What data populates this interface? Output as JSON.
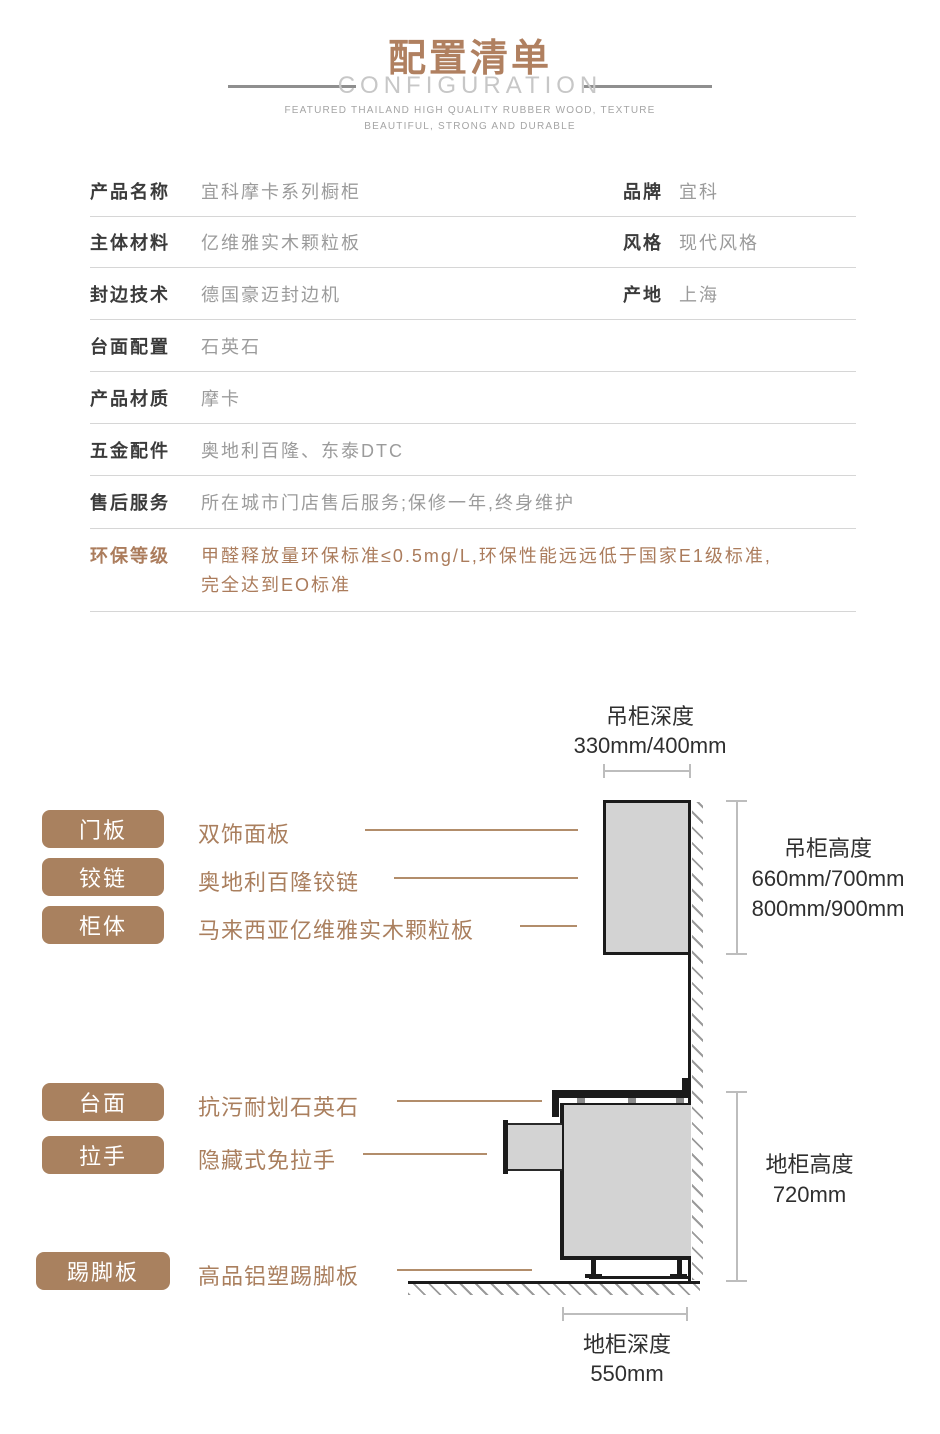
{
  "header": {
    "title": "配置清单",
    "subtitle": "CONFIGURATION",
    "tagline_line1": "FEATURED THAILAND HIGH QUALITY RUBBER WOOD, TEXTURE",
    "tagline_line2": "BEAUTIFUL, STRONG AND DURABLE"
  },
  "spec_table": {
    "rows": [
      {
        "label": "产品名称",
        "value": "宜科摩卡系列橱柜",
        "label2": "品牌",
        "value2": "宜科"
      },
      {
        "label": "主体材料",
        "value": "亿维雅实木颗粒板",
        "label2": "风格",
        "value2": "现代风格"
      },
      {
        "label": "封边技术",
        "value": "德国豪迈封边机",
        "label2": "产地",
        "value2": "上海"
      },
      {
        "label": "台面配置",
        "value": "石英石"
      },
      {
        "label": "产品材质",
        "value": "摩卡"
      },
      {
        "label": "五金配件",
        "value": "奥地利百隆、东泰DTC"
      },
      {
        "label": "售后服务",
        "value": "所在城市门店售后服务;保修一年,终身维护"
      },
      {
        "label": "环保等级",
        "value_line1": "甲醛释放量环保标准≤0.5mg/L,环保性能远远低于国家E1级标准,",
        "value_line2": "完全达到EO标准"
      }
    ]
  },
  "component_labels": [
    {
      "tag": "门板",
      "desc": "双饰面板"
    },
    {
      "tag": "铰链",
      "desc": "奥地利百隆铰链"
    },
    {
      "tag": "柜体",
      "desc": "马来西亚亿维雅实木颗粒板"
    },
    {
      "tag": "台面",
      "desc": "抗污耐划石英石"
    },
    {
      "tag": "拉手",
      "desc": "隐藏式免拉手"
    },
    {
      "tag": "踢脚板",
      "desc": "高品铝塑踢脚板"
    }
  ],
  "dimensions": {
    "wall_depth_label": "吊柜深度",
    "wall_depth_value": "330mm/400mm",
    "wall_height_label": "吊柜高度",
    "wall_height_value1": "660mm/700mm",
    "wall_height_value2": "800mm/900mm",
    "base_height_label": "地柜高度",
    "base_height_value": "720mm",
    "base_depth_label": "地柜深度",
    "base_depth_value": "550mm"
  },
  "colors": {
    "title_brown": "#b08060",
    "brand_brown": "#a9815f",
    "env_text_brown": "#ab7c5c",
    "label_dark": "#3b3b3b",
    "value_gray": "#9b9b9b",
    "divider_gray": "#d6d6d6",
    "cabinet_fill": "#d3d3d3",
    "cabinet_stroke": "#1b1b1b",
    "dimension_gray": "#bdbdbd"
  }
}
